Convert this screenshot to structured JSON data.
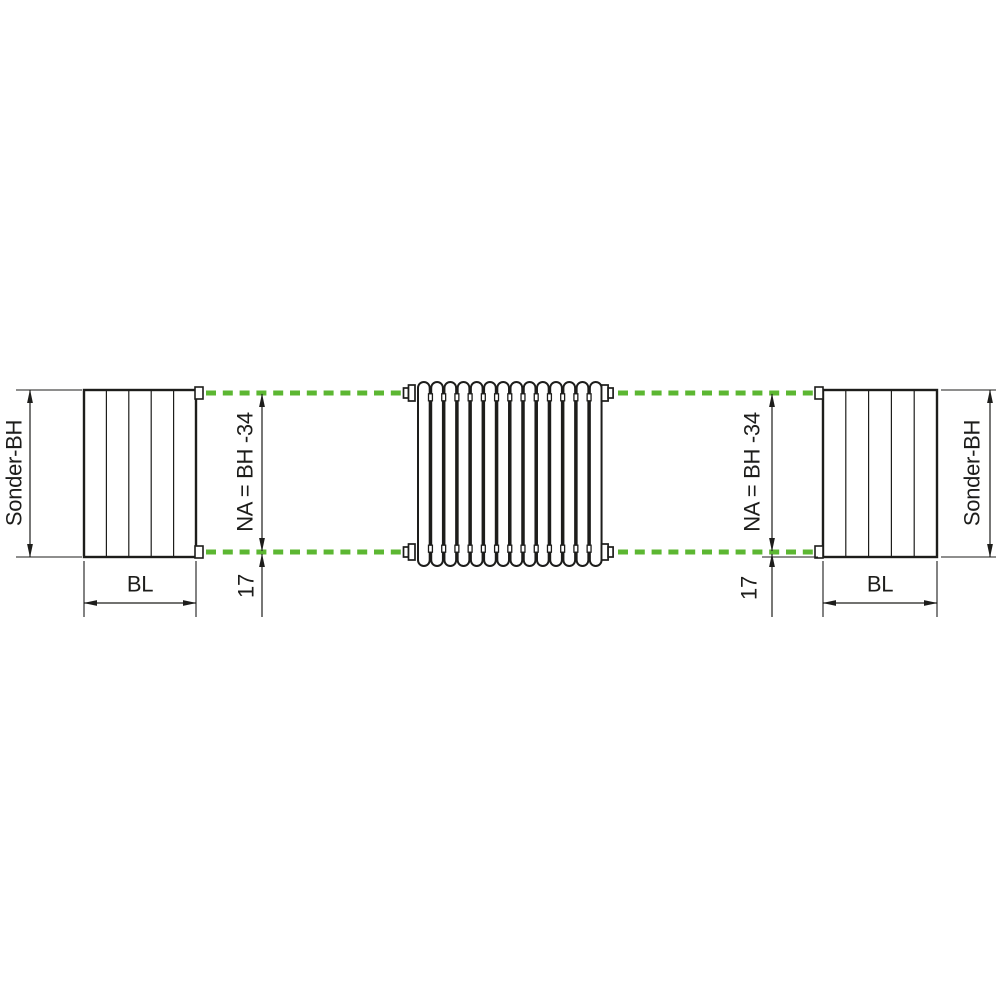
{
  "colors": {
    "accent_green": "#5cb732",
    "line_black": "#1d1d1b"
  },
  "diagram": {
    "kind": "radiator-connection-dimension-drawing",
    "dimensions": {
      "special_height": "Sonder-BH",
      "block_width": "BL",
      "nipple_spacing": "NA = BH -34",
      "bottom_offset": "17"
    },
    "radiator": {
      "tube_count": 14
    }
  }
}
